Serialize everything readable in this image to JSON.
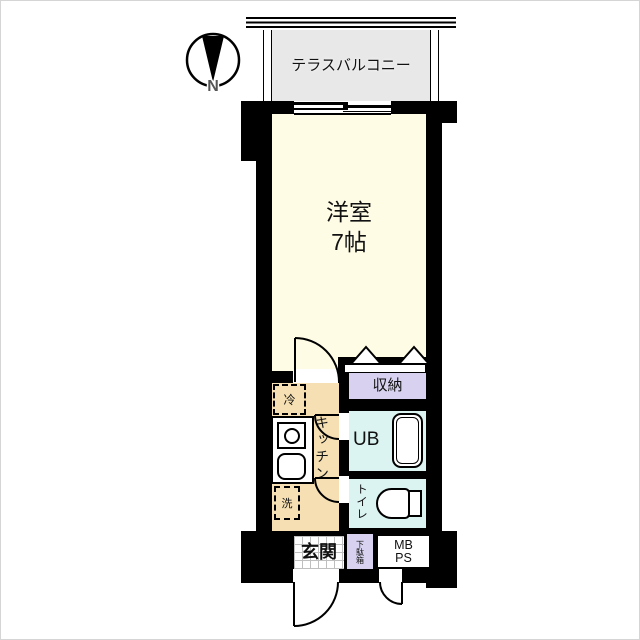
{
  "plan_type": "apartment-floor-plan",
  "colors": {
    "paper": "#ffffff",
    "wall": "#000000",
    "main-room": "#FFFCE6",
    "kitchen": "#F6DFB2",
    "closet": "#D8D2F0",
    "bath": "#DBF3F1",
    "balcony": "#E8E8E8",
    "tile-line": "#bfbfbf",
    "text": "#111111"
  },
  "compass": {
    "label": "N"
  },
  "balcony": {
    "label": "テラスバルコニー"
  },
  "rooms": {
    "main": {
      "name": "洋室",
      "size": "7帖"
    },
    "closet": {
      "label": "収納"
    },
    "unit_bath": {
      "label": "UB"
    },
    "toilet": {
      "label": "トイレ"
    },
    "kitchen": {
      "label": "キッチン",
      "fridge": "冷",
      "washer": "洗"
    },
    "entrance": {
      "label": "玄関",
      "shoe_cabinet": "下駄箱"
    },
    "meter_box": {
      "line1": "MB",
      "line2": "PS"
    }
  }
}
